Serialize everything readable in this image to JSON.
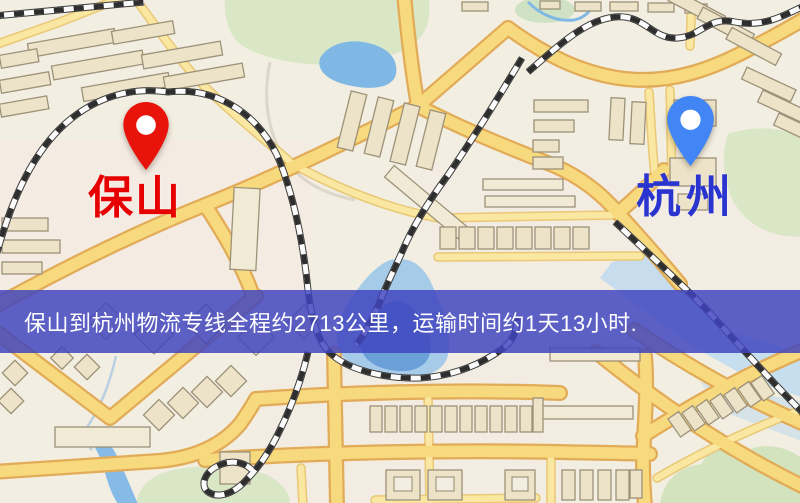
{
  "banner": {
    "text": "保山到杭州物流专线全程约2713公里，运输时间约1天13小时.",
    "background_color": "#3f44bf",
    "text_color": "#ffffff"
  },
  "pins": {
    "origin": {
      "label": "保山",
      "pin_color": "#e8130b",
      "label_color": "#e60000",
      "icon": "map-pin"
    },
    "destination": {
      "label": "杭州",
      "pin_color": "#4285f4",
      "label_color": "#2a34cf",
      "icon": "map-pin"
    }
  },
  "route": {
    "from": "保山",
    "to": "杭州",
    "service": "物流专线",
    "distance_text": "约2713公里",
    "duration_text": "约1天13小时"
  },
  "map_palette": {
    "background": "#f2eee1",
    "road_fill": "#f7d97e",
    "road_casing": "#e2ab57",
    "park": "#d9e7c6",
    "water": "#7fb7e5",
    "building": "#ece3c8",
    "railway_dark": "#2e2e2e"
  }
}
